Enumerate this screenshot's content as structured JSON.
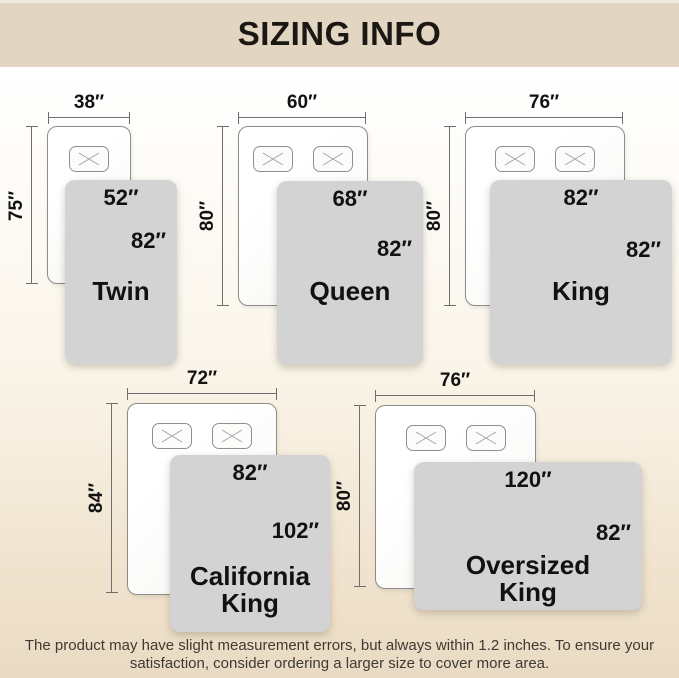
{
  "title": "SIZING INFO",
  "footer": {
    "line1": "The product may have slight measurement errors, but always within 1.2 inches. To ensure your",
    "line2": "satisfaction, consider ordering a larger size to cover more area."
  },
  "colors": {
    "header_band": "#e2d5c2",
    "background_bottom": "#e9dac3",
    "blanket_gray": "#d3d3d3",
    "bed_outline": "#8d8d8d",
    "text": "#111111"
  },
  "diagrams": [
    {
      "name": "Twin",
      "bed_width": "38″",
      "bed_length": "75″",
      "blanket_width": "52″",
      "blanket_length": "82″",
      "pillow_count": 1
    },
    {
      "name": "Queen",
      "bed_width": "60″",
      "bed_length": "80″",
      "blanket_width": "68″",
      "blanket_length": "82″",
      "pillow_count": 2
    },
    {
      "name": "King",
      "bed_width": "76″",
      "bed_length": "80″",
      "blanket_width": "82″",
      "blanket_length": "82″",
      "pillow_count": 2
    },
    {
      "name": "California King",
      "bed_width": "72″",
      "bed_length": "84″",
      "blanket_width": "82″",
      "blanket_length": "102″",
      "pillow_count": 2
    },
    {
      "name": "Oversized King",
      "bed_width": "76″",
      "bed_length": "80″",
      "blanket_width": "120″",
      "blanket_length": "82″",
      "pillow_count": 2
    }
  ]
}
